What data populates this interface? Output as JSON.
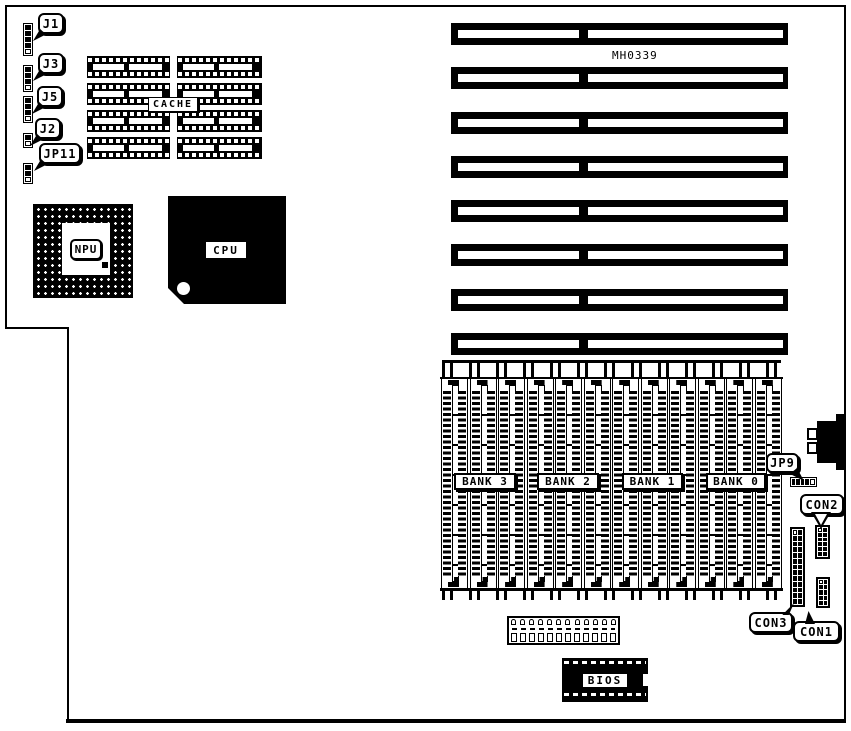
{
  "colors": {
    "ink": "#000000",
    "paper": "#ffffff"
  },
  "board": {
    "part_number": "MH0339"
  },
  "jumpers_left": [
    {
      "label": "J1",
      "cells": 5
    },
    {
      "label": "J3",
      "cells": 4
    },
    {
      "label": "J5",
      "cells": 4
    },
    {
      "label": "J2",
      "cells": 2
    },
    {
      "label": "JP11",
      "cells": 3
    }
  ],
  "jumper_jp9": {
    "label": "JP9",
    "cells": 5
  },
  "chips": {
    "cache": "CACHE",
    "npu": "NPU",
    "cpu": "CPU",
    "bios": "BIOS"
  },
  "memory_banks": [
    "BANK 3",
    "BANK 2",
    "BANK 1",
    "BANK 0"
  ],
  "connectors": {
    "con1": "CON1",
    "con2": "CON2",
    "con3": "CON3"
  },
  "counts": {
    "isa_slots": 8,
    "simm_sockets": 12,
    "cache_chips": 8,
    "con1_rows": 5,
    "con2_rows": 6,
    "con3_rows": 13,
    "power_pins": 12
  }
}
